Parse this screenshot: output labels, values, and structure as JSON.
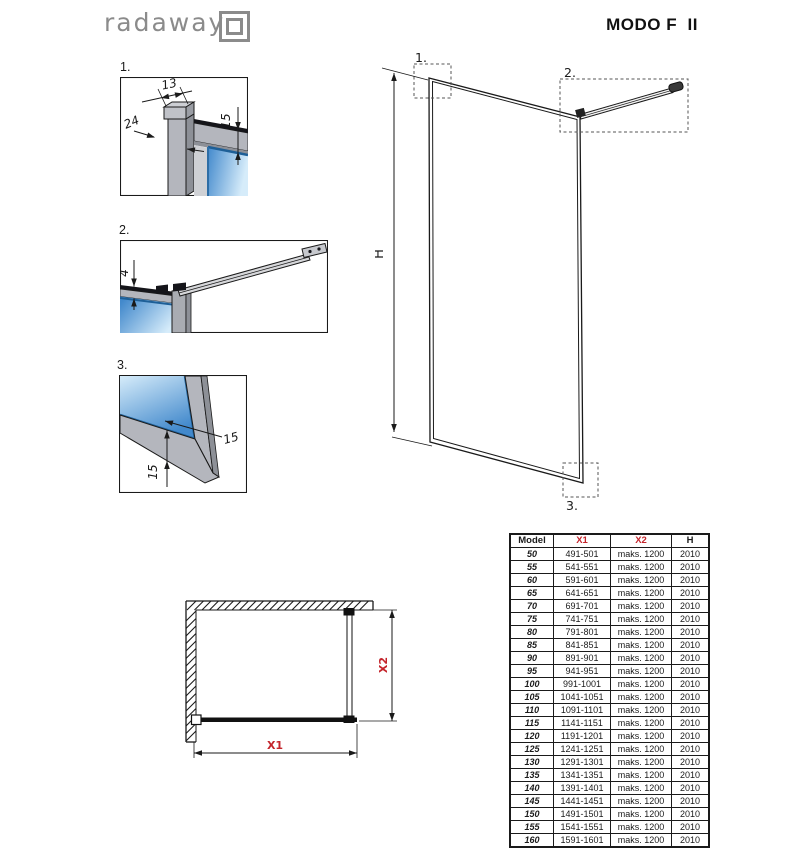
{
  "header": {
    "logo_text": "radaway",
    "title": "MODO F  II"
  },
  "details": [
    {
      "label": "1.",
      "dim_width": "13",
      "dim_depth": "24",
      "dim_glass_inset": "15"
    },
    {
      "label": "2.",
      "dim_bar": "4"
    },
    {
      "label": "3.",
      "dim_frame_side": "15",
      "dim_frame_bottom": "15"
    }
  ],
  "elevation": {
    "callout_1": "1.",
    "callout_2": "2.",
    "callout_3": "3.",
    "dim_height": "H"
  },
  "plan": {
    "dim_width": "X1",
    "dim_depth": "X2"
  },
  "table": {
    "headers": [
      "Model",
      "X1",
      "X2",
      "H"
    ],
    "rows": [
      [
        "50",
        "491-501",
        "maks. 1200",
        "2010"
      ],
      [
        "55",
        "541-551",
        "maks. 1200",
        "2010"
      ],
      [
        "60",
        "591-601",
        "maks. 1200",
        "2010"
      ],
      [
        "65",
        "641-651",
        "maks. 1200",
        "2010"
      ],
      [
        "70",
        "691-701",
        "maks. 1200",
        "2010"
      ],
      [
        "75",
        "741-751",
        "maks. 1200",
        "2010"
      ],
      [
        "80",
        "791-801",
        "maks. 1200",
        "2010"
      ],
      [
        "85",
        "841-851",
        "maks. 1200",
        "2010"
      ],
      [
        "90",
        "891-901",
        "maks. 1200",
        "2010"
      ],
      [
        "95",
        "941-951",
        "maks. 1200",
        "2010"
      ],
      [
        "100",
        "991-1001",
        "maks. 1200",
        "2010"
      ],
      [
        "105",
        "1041-1051",
        "maks. 1200",
        "2010"
      ],
      [
        "110",
        "1091-1101",
        "maks. 1200",
        "2010"
      ],
      [
        "115",
        "1141-1151",
        "maks. 1200",
        "2010"
      ],
      [
        "120",
        "1191-1201",
        "maks. 1200",
        "2010"
      ],
      [
        "125",
        "1241-1251",
        "maks. 1200",
        "2010"
      ],
      [
        "130",
        "1291-1301",
        "maks. 1200",
        "2010"
      ],
      [
        "135",
        "1341-1351",
        "maks. 1200",
        "2010"
      ],
      [
        "140",
        "1391-1401",
        "maks. 1200",
        "2010"
      ],
      [
        "145",
        "1441-1451",
        "maks. 1200",
        "2010"
      ],
      [
        "150",
        "1491-1501",
        "maks. 1200",
        "2010"
      ],
      [
        "155",
        "1541-1551",
        "maks. 1200",
        "2010"
      ],
      [
        "160",
        "1591-1601",
        "maks. 1200",
        "2010"
      ]
    ]
  },
  "colors": {
    "accent_red": "#c4242b",
    "line_black": "#1a1a1a",
    "frame_gray": "#b4b6bd",
    "frame_gray_dark": "#8d9097",
    "glass_dark": "#4289cc",
    "glass_light": "#d6ecfa",
    "logo_gray": "#8b8b8b"
  }
}
